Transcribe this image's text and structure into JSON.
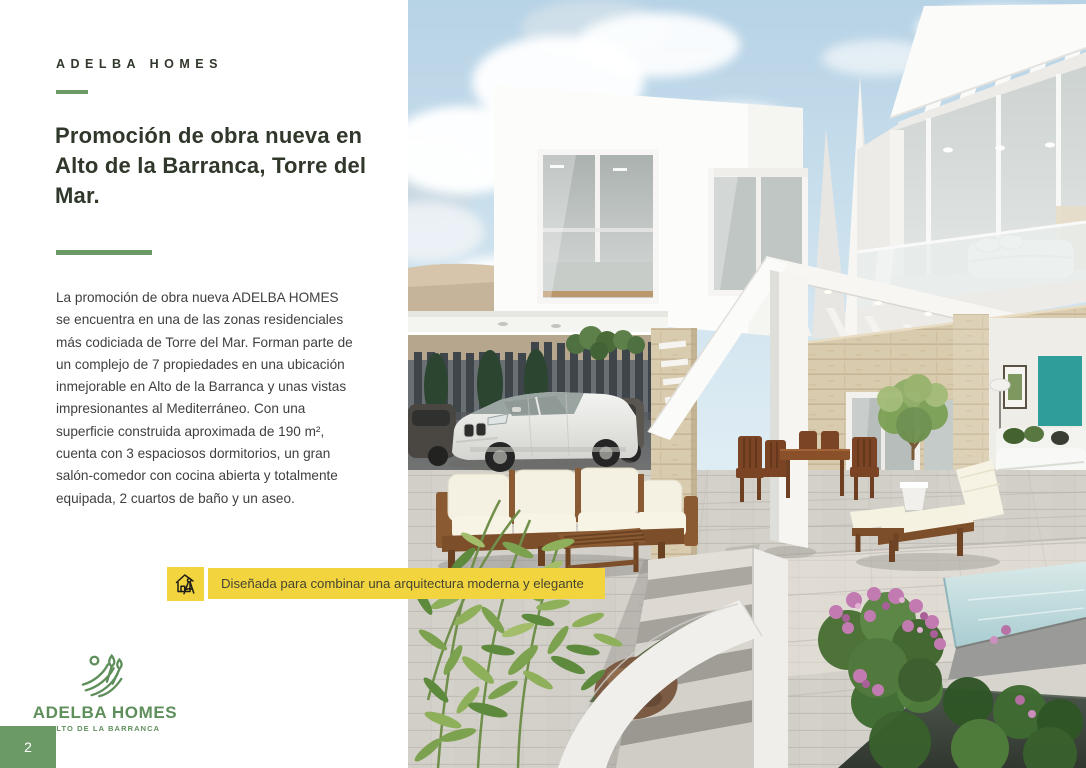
{
  "brand": {
    "header": "ADELBA HOMES",
    "logo": {
      "title": "ADELBA HOMES",
      "subtitle": "ALTO DE LA BARRANCA",
      "icon": "field-sprout-icon"
    }
  },
  "article": {
    "title_lines": [
      "Promoción de obra nueva en",
      "Alto de la Barranca, Torre del",
      "Mar."
    ],
    "body_lines": [
      "La promoción de obra nueva ADELBA HOMES",
      "se encuentra en una de las zonas residenciales",
      "más codiciada de Torre del Mar. Forman parte de",
      "un complejo de 7 propiedades en una ubicación",
      "inmejorable en Alto de la Barranca y unas vistas",
      "impresionantes al Mediterráneo. Con una",
      "superficie construida aproximada de 190 m²,",
      "cuenta con 3 espaciosos dormitorios, un gran",
      "salón-comedor con cocina abierta y totalmente",
      "equipada, 2 cuartos de baño y un aseo."
    ]
  },
  "highlight": {
    "icon": "house-compass-icon",
    "text": "Diseñada para combinar una arquitectura moderna y elegante"
  },
  "footer": {
    "page_number": "2"
  },
  "colors": {
    "accent_green": "#6B9A67",
    "logo_green": "#5E8F5B",
    "highlight_yellow": "#F2D43F",
    "title_text": "#30372B",
    "body_text": "#3F4040",
    "highlight_text": "#45452F"
  }
}
